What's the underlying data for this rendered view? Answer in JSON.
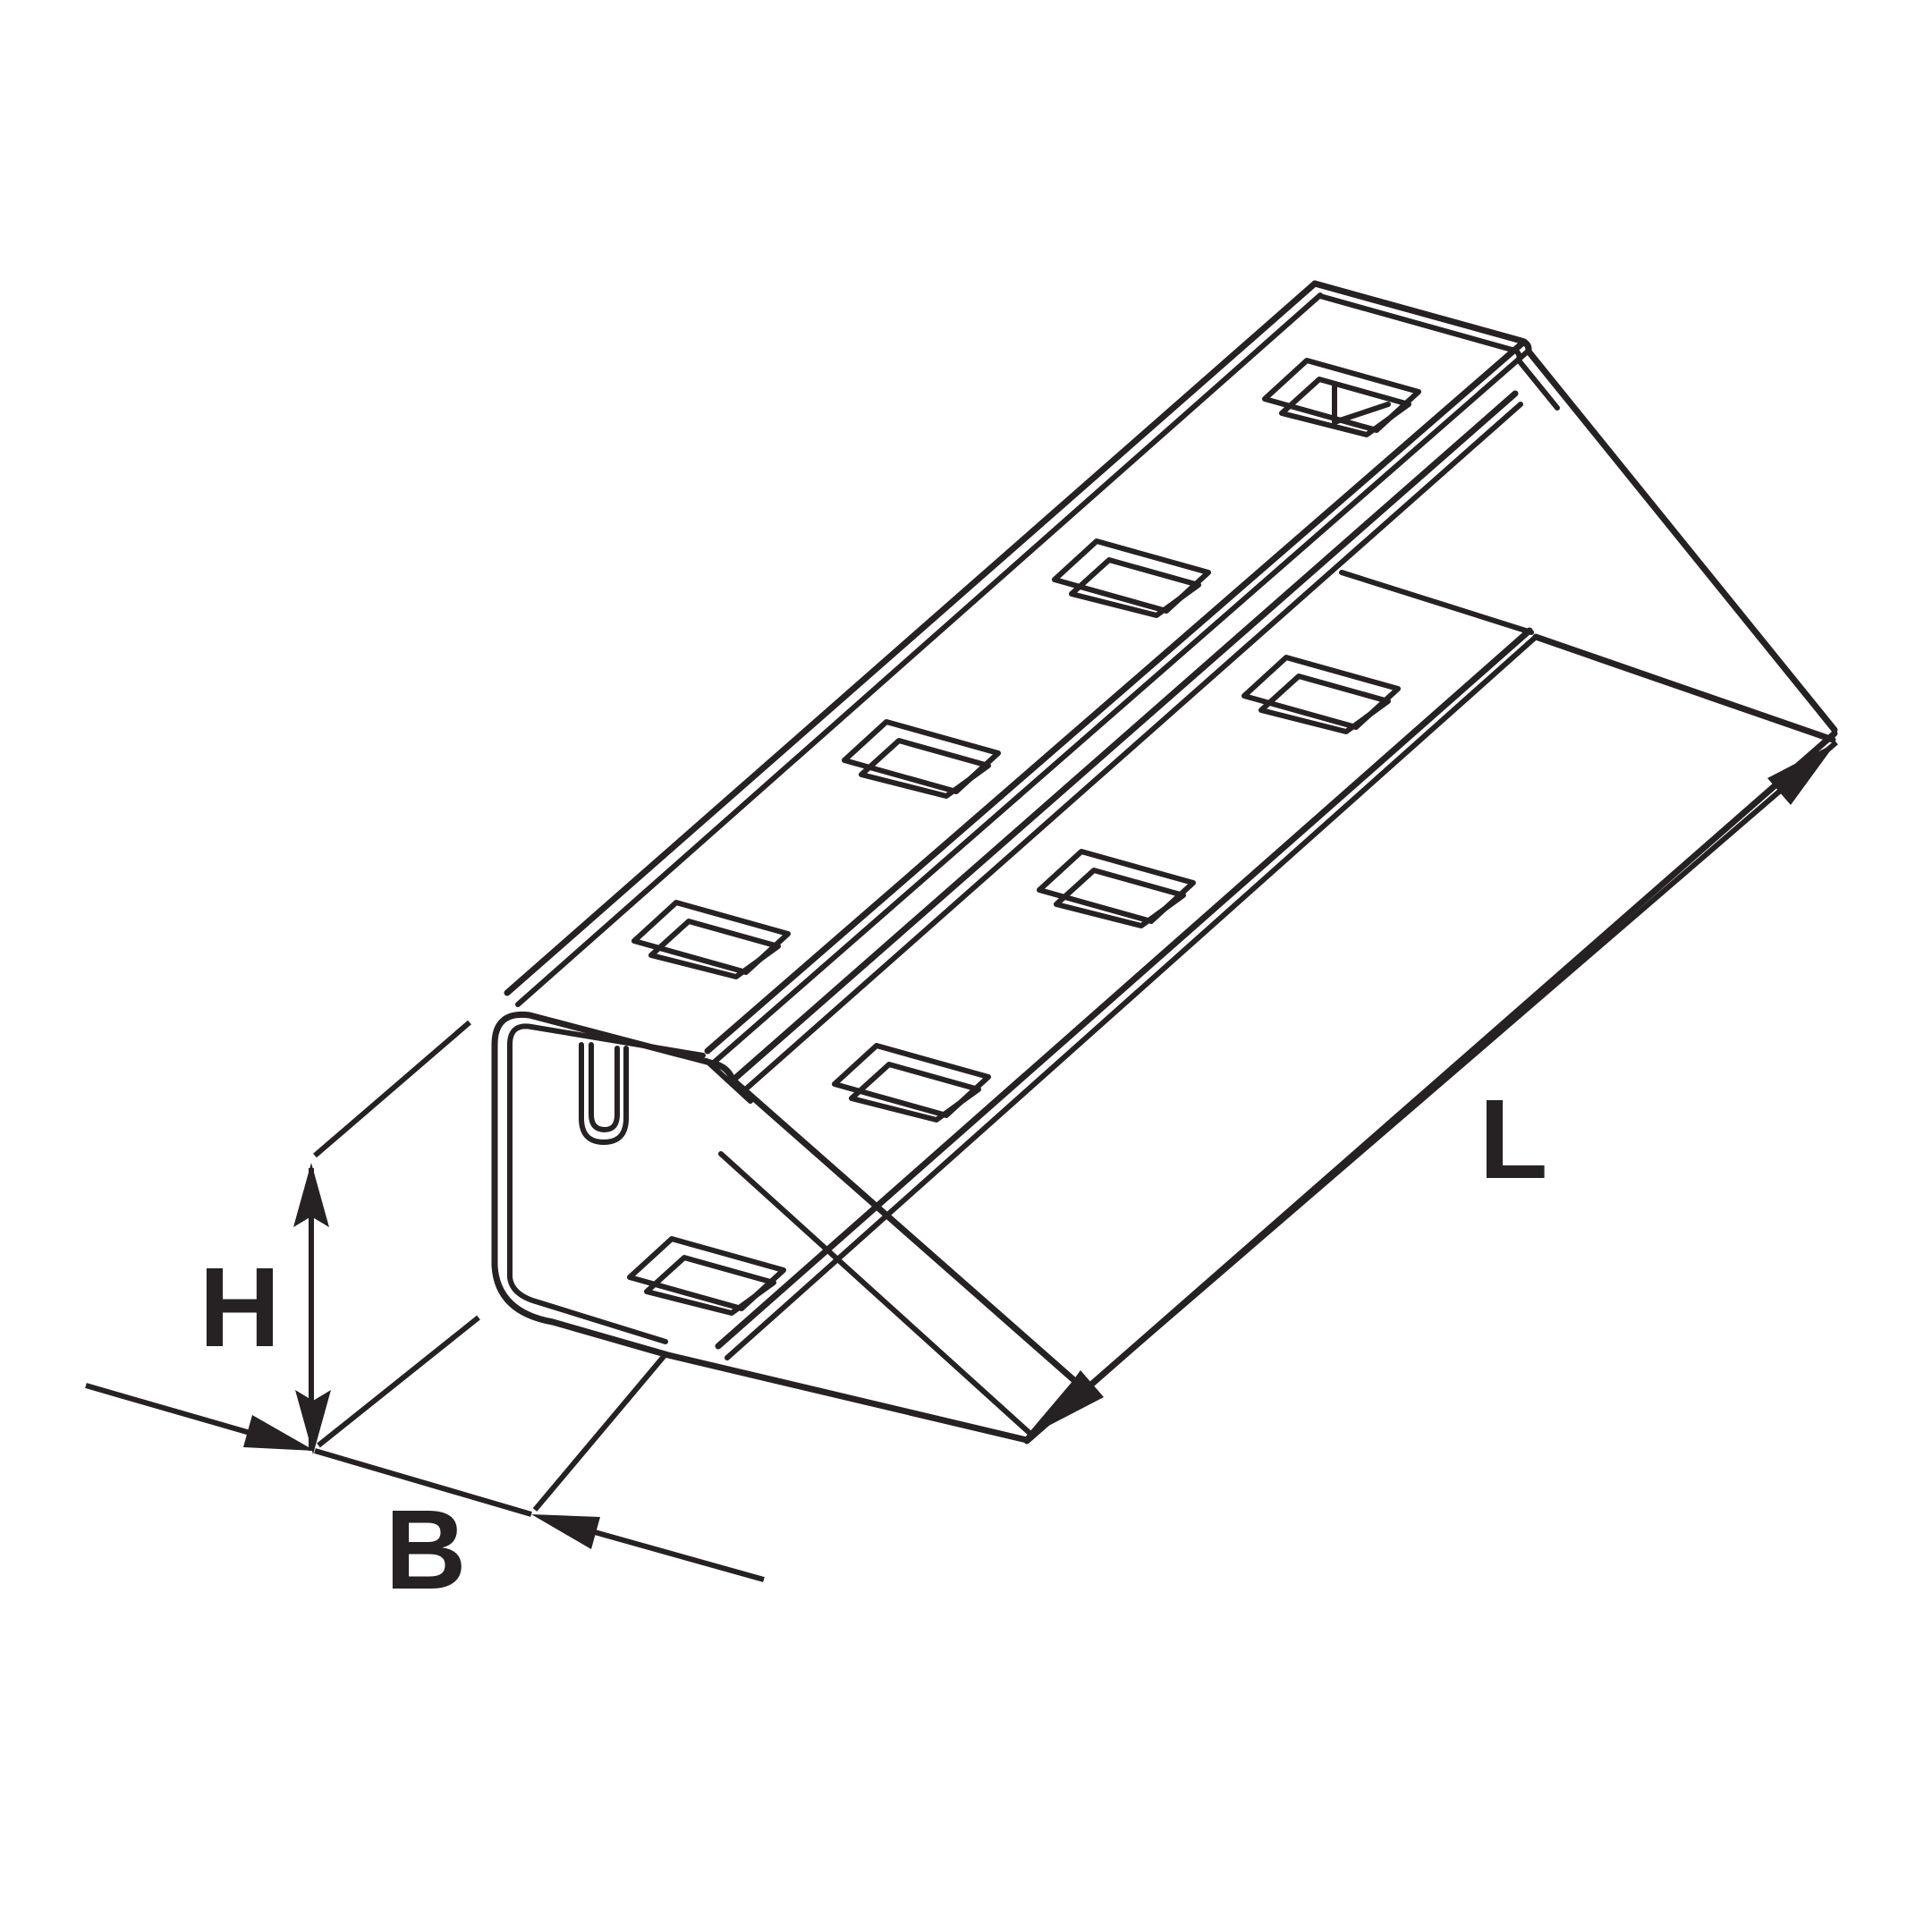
{
  "labels": {
    "height": "H",
    "width": "B",
    "length": "L"
  },
  "colors": {
    "line": "#262123",
    "background": "#ffffff"
  },
  "drawing": {
    "object": "perforated-channel-profile",
    "view": "isometric",
    "web_slot_count": 4,
    "flange_slot_count": 4
  }
}
